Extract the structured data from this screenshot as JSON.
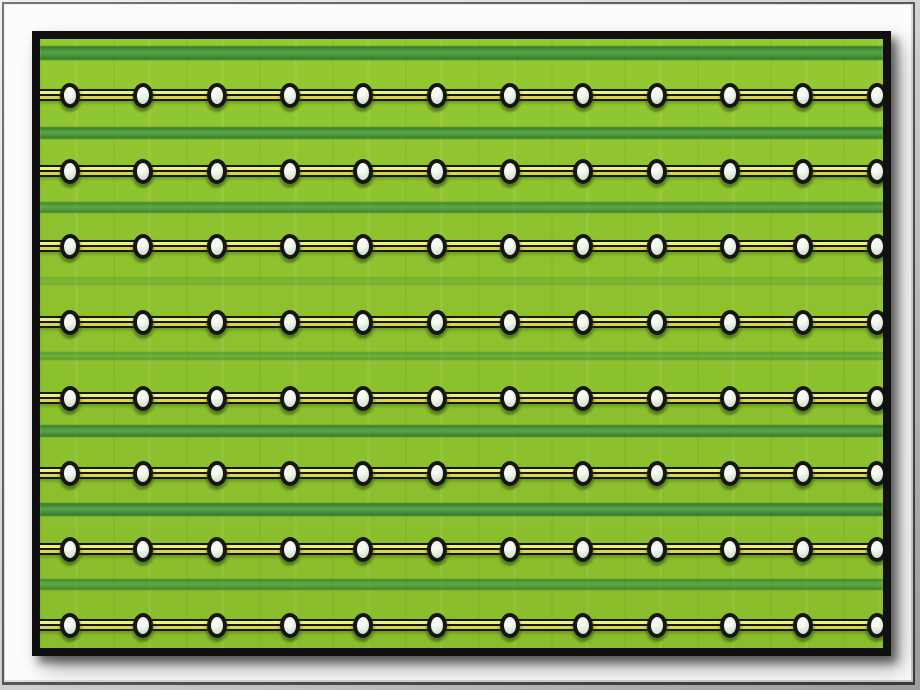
{
  "scene": {
    "type": "framed-photo",
    "subject": "Lime green fabric panel with eight horizontal beaded cords and soft dark-green stripes, in a black frame on a white mat inside a metallic beveled border",
    "colors": {
      "bezel_light": "#f0f0f0",
      "bezel_mid": "#9e9e9e",
      "bezel_dark": "#3a3a3a",
      "mat_white": "#fcfcfc",
      "frame_black": "#101010",
      "background_green": "#8ec32f",
      "stripe_green": "#57a748",
      "wire_black": "#17170a",
      "wire_yellow_bright": "#eef07c",
      "wire_yellow_dark": "#d9d64b",
      "bead_outline": "#161616",
      "bead_fill": "#dfe9d8",
      "bead_highlight": "#f6faf1"
    },
    "pattern": {
      "row_count": 8,
      "beads_per_row": 12,
      "row_centers_y": [
        56,
        132,
        207,
        283,
        359,
        434,
        510,
        586
      ],
      "bead_centers_x": [
        30,
        103,
        177,
        250,
        323,
        397,
        470,
        543,
        617,
        690,
        763,
        837
      ],
      "bead_width": 20,
      "bead_height": 25,
      "cord_height": 12,
      "stripes": [
        {
          "y": 14,
          "height": 14,
          "opacity": 1.0
        },
        {
          "y": 94,
          "height": 12,
          "opacity": 0.95
        },
        {
          "y": 168,
          "height": 11,
          "opacity": 0.85
        },
        {
          "y": 242,
          "height": 8,
          "opacity": 0.3
        },
        {
          "y": 317,
          "height": 8,
          "opacity": 0.55
        },
        {
          "y": 392,
          "height": 12,
          "opacity": 0.95
        },
        {
          "y": 470,
          "height": 13,
          "opacity": 1.0
        },
        {
          "y": 545,
          "height": 11,
          "opacity": 0.8
        }
      ]
    }
  }
}
